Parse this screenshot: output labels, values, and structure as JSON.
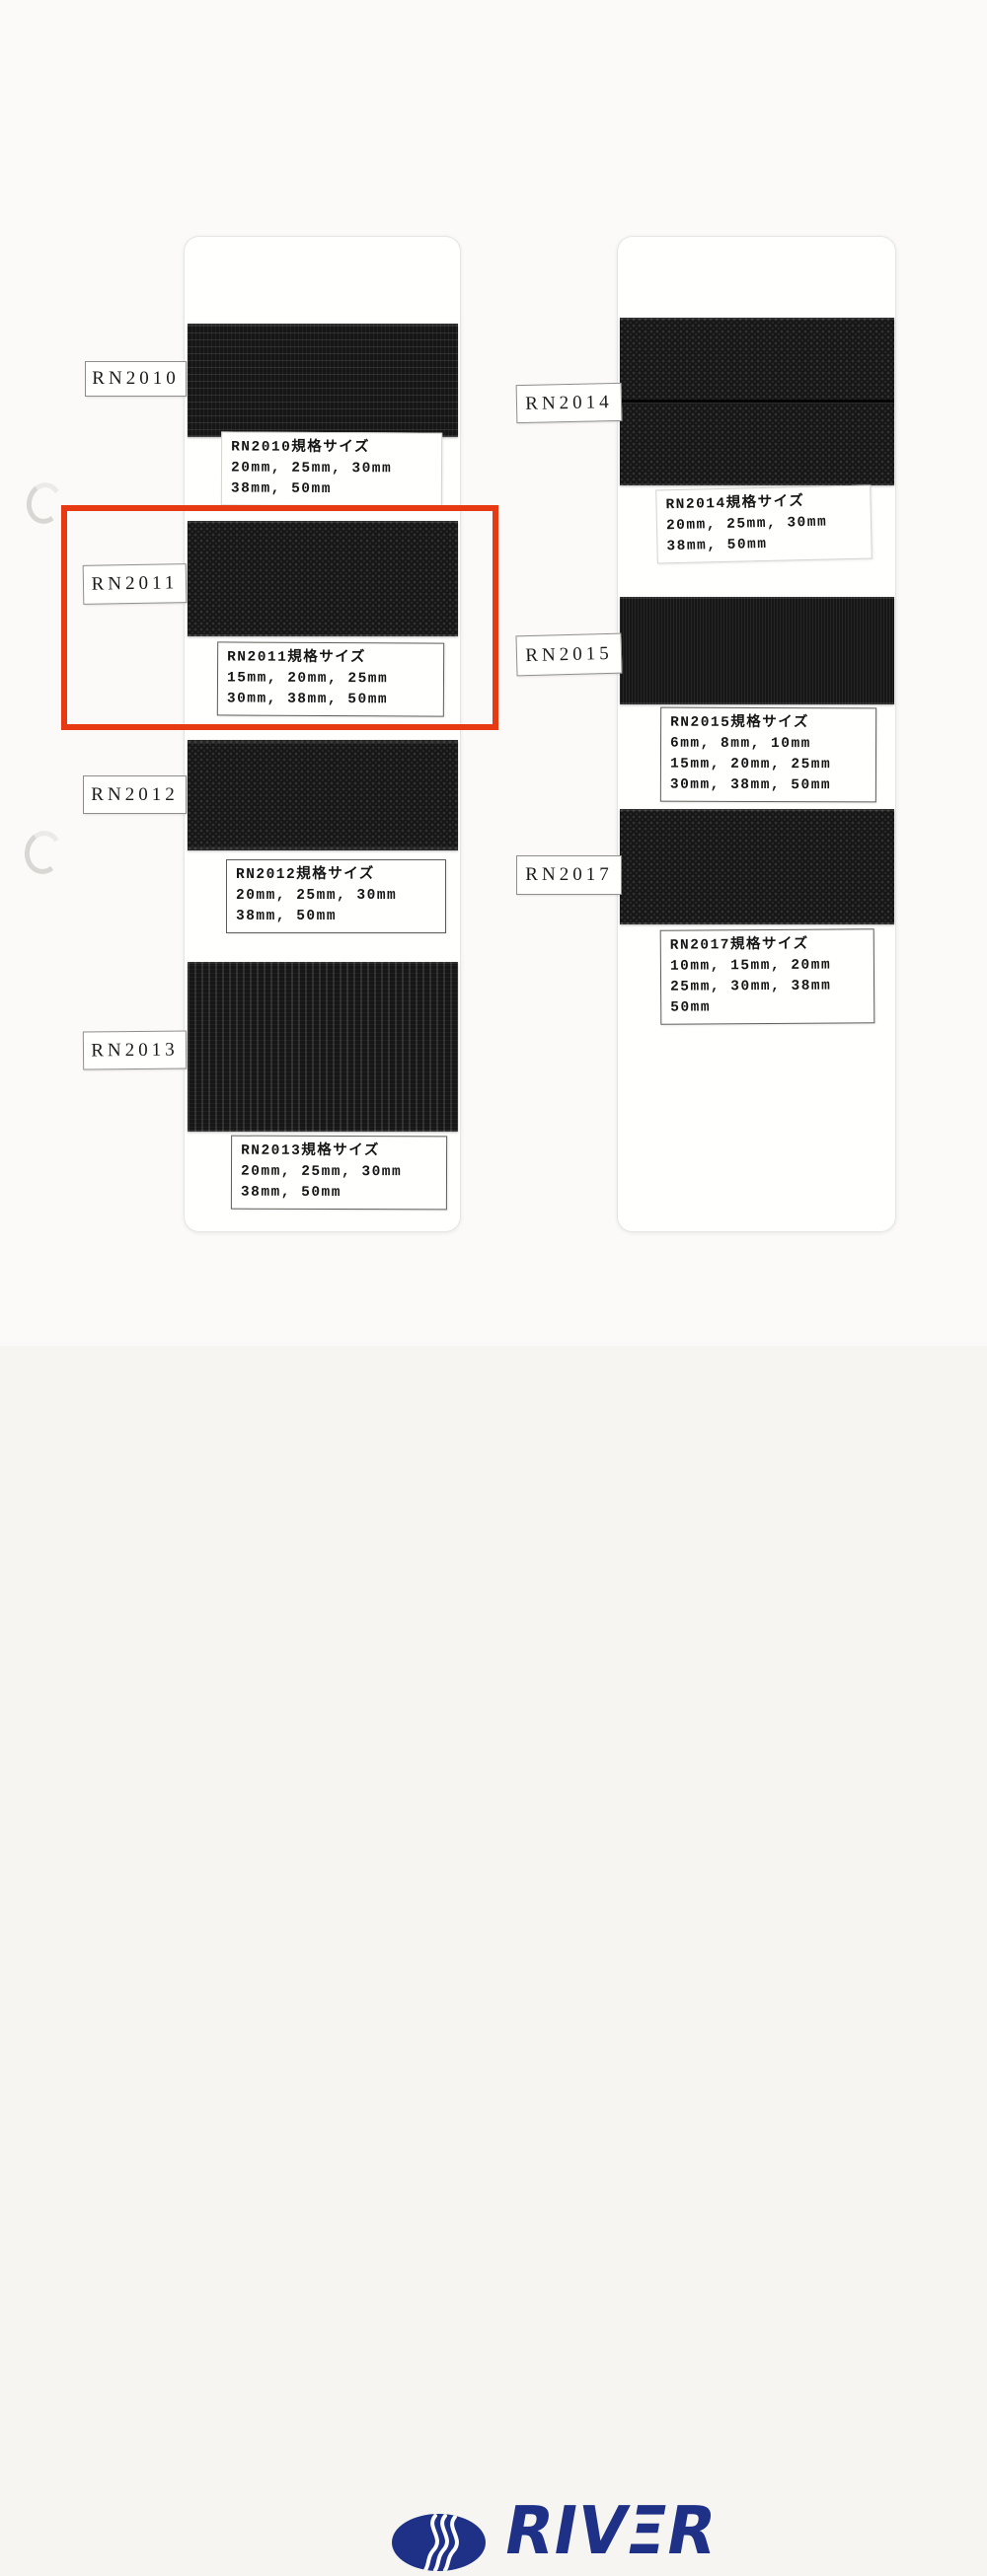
{
  "page": {
    "background_color": "#fbfaf8",
    "card_color": "#fffffe",
    "webbing_color": "#161616",
    "highlight_color": "#e73a12",
    "brand_color": "#1e3187"
  },
  "columns": [
    {
      "samples": [
        {
          "code": "RN2010",
          "spec_title": "RN2010規格サイズ",
          "spec_lines": [
            "20mm, 25mm, 30mm",
            "38mm, 50mm"
          ]
        },
        {
          "code": "RN2011",
          "spec_title": "RN2011規格サイズ",
          "spec_lines": [
            "15mm, 20mm, 25mm",
            "30mm, 38mm, 50mm"
          ]
        },
        {
          "code": "RN2012",
          "spec_title": "RN2012規格サイズ",
          "spec_lines": [
            "20mm, 25mm, 30mm",
            "38mm, 50mm"
          ]
        },
        {
          "code": "RN2013",
          "spec_title": "RN2013規格サイズ",
          "spec_lines": [
            "20mm, 25mm, 30mm",
            "38mm, 50mm"
          ]
        }
      ]
    },
    {
      "samples": [
        {
          "code": "RN2014",
          "spec_title": "RN2014規格サイズ",
          "spec_lines": [
            "20mm, 25mm, 30mm",
            "38mm, 50mm"
          ]
        },
        {
          "code": "RN2015",
          "spec_title": "RN2015規格サイズ",
          "spec_lines": [
            "6mm, 8mm, 10mm",
            "15mm, 20mm, 25mm",
            "30mm, 38mm, 50mm"
          ]
        },
        {
          "code": "RN2017",
          "spec_title": "RN2017規格サイズ",
          "spec_lines": [
            "10mm, 15mm, 20mm",
            "25mm, 30mm, 38mm",
            "50mm"
          ]
        }
      ]
    }
  ],
  "highlight": {
    "target_code": "RN2011"
  },
  "logo": {
    "text": "RIVER",
    "display_parts": {
      "left": "RIV",
      "e": "Ξ",
      "right": "R"
    }
  }
}
